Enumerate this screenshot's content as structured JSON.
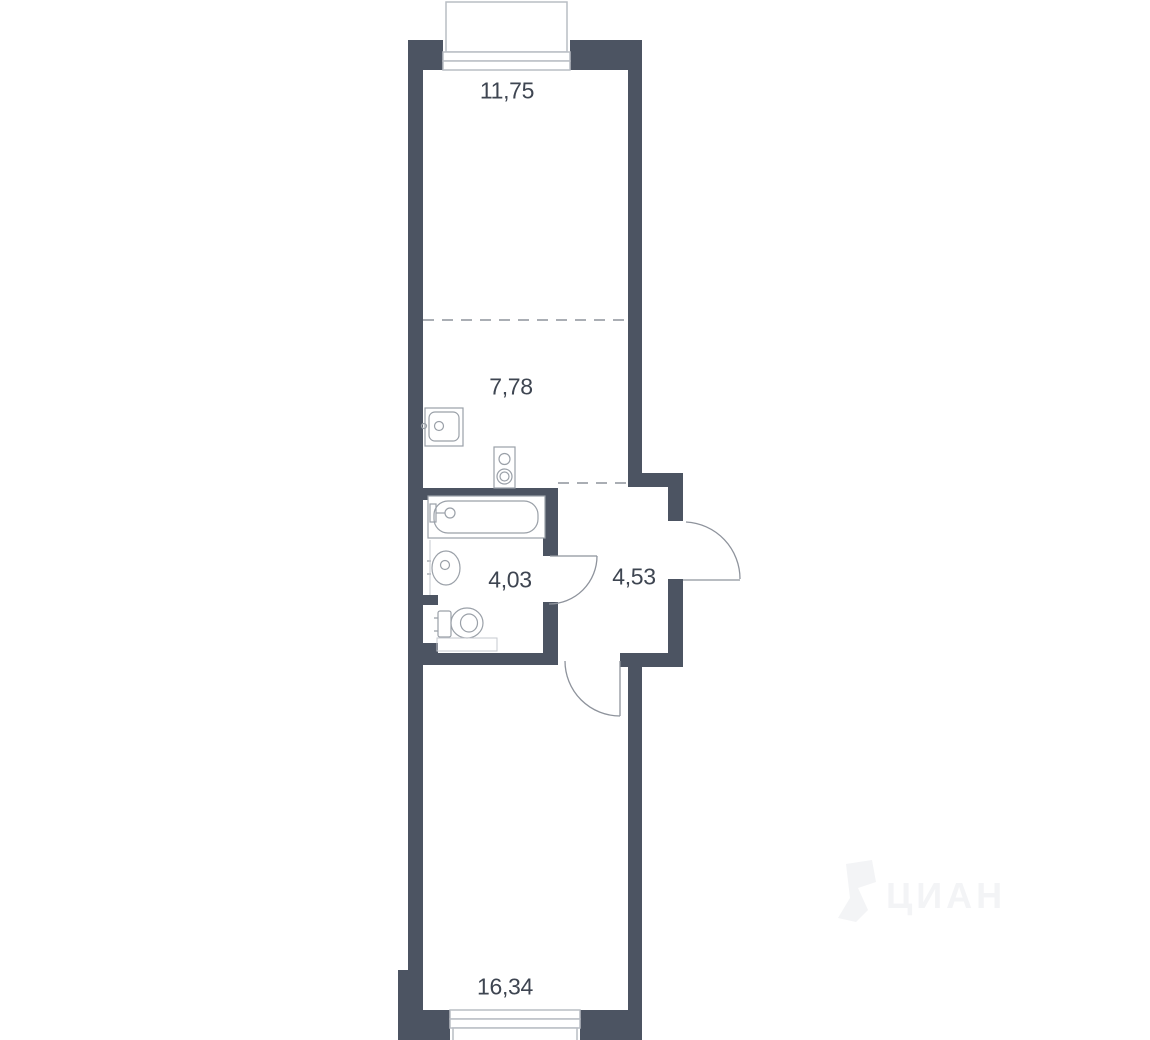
{
  "plan": {
    "colors": {
      "wall": "#4c5462",
      "line": "#9aa0a8",
      "door": "#8e939c",
      "frame": "#b9bdc4",
      "label": "#3e4551",
      "watermark": "#f3f4f6"
    },
    "rooms": [
      {
        "name": "room-top",
        "area": "11,75"
      },
      {
        "name": "kitchen",
        "area": "7,78"
      },
      {
        "name": "bathroom",
        "area": "4,03"
      },
      {
        "name": "hallway",
        "area": "4,53"
      },
      {
        "name": "room-bottom",
        "area": "16,34"
      }
    ],
    "fixtures": [
      "kitchen-sink",
      "stove",
      "bathtub",
      "wash-basin",
      "toilet"
    ],
    "watermark_text": "ЦИАН"
  }
}
